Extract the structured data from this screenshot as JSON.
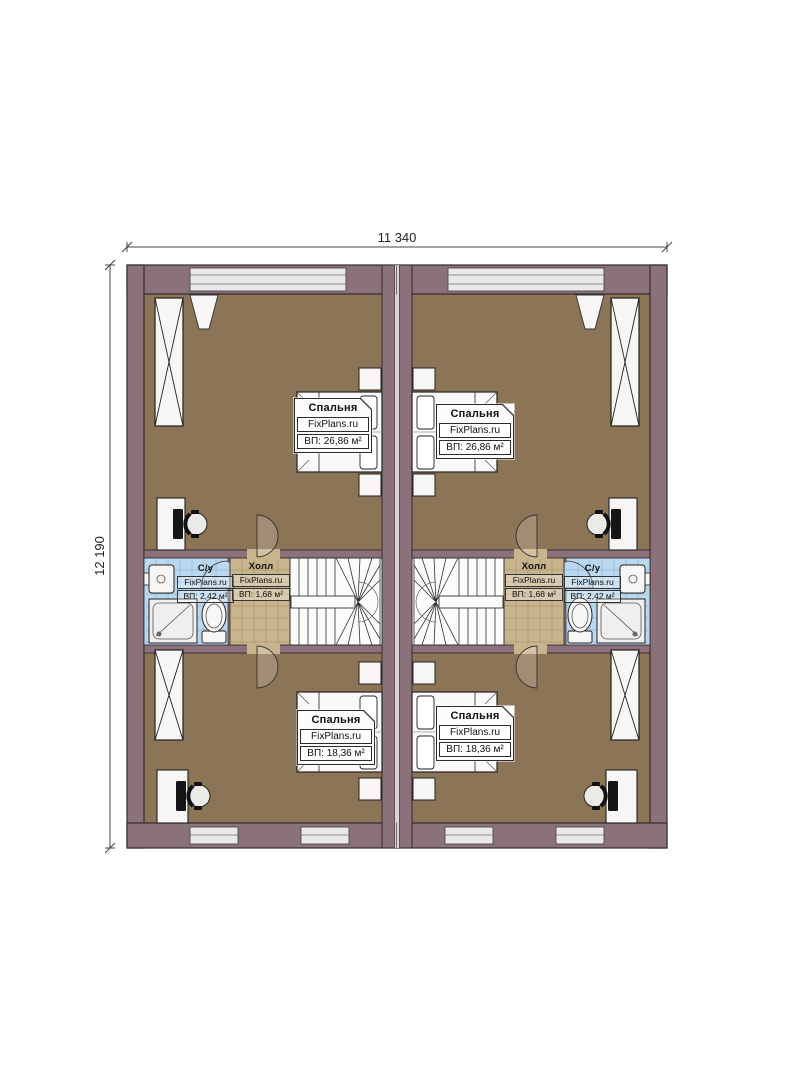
{
  "plan": {
    "title": "floor-plan-duplex-second-floor",
    "dimension_width": "11 340",
    "dimension_height": "12 190",
    "watermark": "FixPlans.ru",
    "rooms": {
      "bedroom_top_left": {
        "name": "Спальня",
        "area": "ВП: 26,86 м²"
      },
      "bedroom_top_right": {
        "name": "Спальня",
        "area": "ВП: 26,86 м²"
      },
      "bedroom_bottom_left": {
        "name": "Спальня",
        "area": "ВП: 18,36 м²"
      },
      "bedroom_bottom_right": {
        "name": "Спальня",
        "area": "ВП: 18,36 м²"
      },
      "hall_left": {
        "name": "Холл",
        "area": "ВП: 1,68 м²"
      },
      "hall_right": {
        "name": "Холл",
        "area": "ВП: 1,68 м²"
      },
      "bath_left": {
        "name": "С/у",
        "area": "ВП: 2,42 м²"
      },
      "bath_right": {
        "name": "С/у",
        "area": "ВП: 2,42 м²"
      }
    },
    "colors": {
      "wall": "#8b7179",
      "outline": "#352b30",
      "bedroom_floor": "#8c7456",
      "hall_tile": "#c9b58d",
      "bath_tile": "#bcd8ee",
      "furniture": "#f7f6f4",
      "window": "#e9e9eb"
    }
  }
}
